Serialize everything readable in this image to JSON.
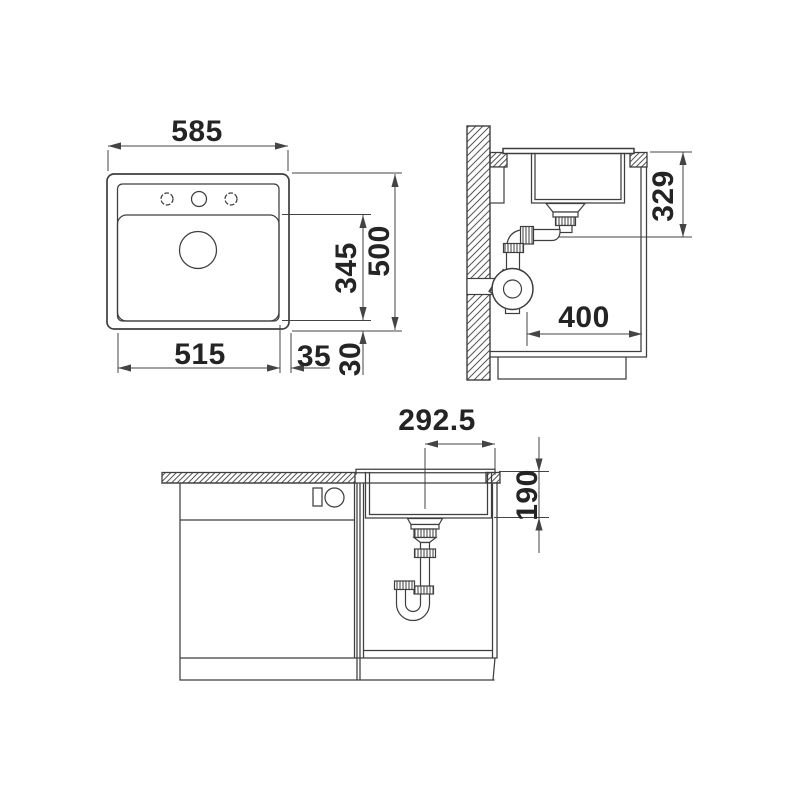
{
  "document": {
    "type": "technical-installation-drawing",
    "subject": "kitchen sink with cabinet and drain plumbing, three orthographic views"
  },
  "colors": {
    "bg": "#ffffff",
    "object": "#3e3e3e",
    "dim": "#444444",
    "text": "#242424"
  },
  "views": {
    "top": {
      "label": "top-view-plan",
      "dims": {
        "width_overall": "585",
        "basin_width": "515",
        "edge_right": "35",
        "basin_length": "345",
        "depth_overall": "500",
        "edge_bottom": "30"
      }
    },
    "side": {
      "label": "side-section-view",
      "dims": {
        "drain_height": "329",
        "drain_offset": "400"
      }
    },
    "front": {
      "label": "front-section-view",
      "dims": {
        "drain_center_offset": "292.5",
        "basin_depth": "190"
      }
    }
  }
}
